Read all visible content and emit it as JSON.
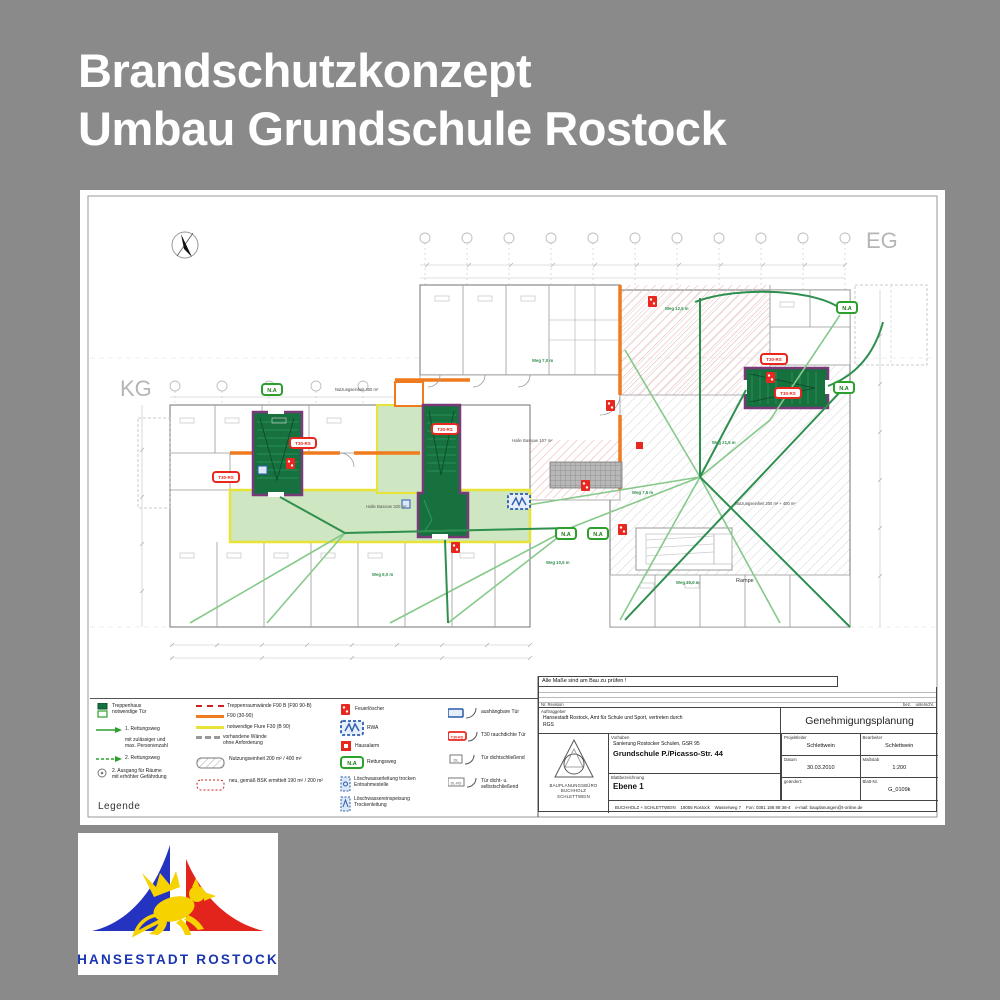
{
  "page": {
    "background": "#8a8a8a",
    "title_line1": "Brandschutzkonzept",
    "title_line2": "Umbau Grundschule Rostock"
  },
  "plan": {
    "floor_eg": "EG",
    "floor_kg": "KG",
    "rampe": "Rampe",
    "halle_small": "Halle Bassow 107 m²",
    "halle_big": "Halle Bassow 320 m²",
    "nutzungseinheit_1": "Nutzungseinheit 200 m² + 400 m²",
    "nutzungseinheit_2": "Nutzungseinheit 400 m²",
    "route_labels": [
      "Weg 7,0 m",
      "Weg 12,5 m",
      "Weg 21,5 m",
      "Weg 7,5 m",
      "Weg 10,5 m",
      "Weg 9,0 m",
      "Weg 30,0 m"
    ],
    "symbol_na": "N.A",
    "symbol_t30": "T30-RS",
    "symbol_rwa": "RWA"
  },
  "legend": {
    "heading": "Legende",
    "treppenhaus_line1": "Treppenhaus",
    "treppenhaus_line2": "notwendige Tür",
    "rettungsweg1": "1. Rettungsweg",
    "personen_line1": "mit zulässiger und",
    "personen_line2": "max. Personenzahl",
    "rettungsweg2": "2. Rettungsweg",
    "ausgang_line1": "2. Ausgang für Räume",
    "ausgang_line2": "mit erhöhter Gefährdung",
    "wall_f90b": "Treppenraumwände F90 B (F90 90-B)",
    "wall_f90": "F90  (30-90)",
    "wall_flur": "notwendige Flure F30 (B 90)",
    "wall_vorhanden_line1": "vorhandene Wände",
    "wall_vorhanden_line2": "ohne Anforderung",
    "nutzung": "Nutzungseinheit  200 m² / 400 m²",
    "nutzung_neu": "neu, gemäß BSK ermittelt  190 m² / 200 m²",
    "feuerloescher": "Feuerlöscher",
    "rwa": "RWA",
    "hausalarm": "Hausalarm",
    "rettungsweg_symbol": "Rettungsweg",
    "loeschwasser1_line1": "Löschwasserleitung trocken",
    "loeschwasser1_line2": "Entnahmestelle",
    "loeschwasser2_line1": "Löschwassereinspeisung",
    "loeschwasser2_line2": "Trockenleitung",
    "tuer_aushaengbar": "aushängbare Tür",
    "tuer_t30": "T30 rauchdichte Tür",
    "tuer_dicht": "Tür dichtschließend",
    "tuer_dicht_selbst": "Tür dicht- u. selbstschließend",
    "sym_t30": "T30-RS",
    "sym_dl": "DL",
    "sym_dlrs": "DL-RS",
    "sym_nr": "N.A"
  },
  "titleblock": {
    "note": "Alle Maße sind am Bau zu prüfen !",
    "rev_label": "Nr.  Revision",
    "rev_bez": "bez.",
    "rev_unterschrift": "unterschr.",
    "client_label": "Auftraggeber",
    "client_line1": "Hansestadt Rostock, Amt für Schule und Sport, vertreten durch",
    "client_line2": "RGS",
    "phase": "Genehmigungsplanung",
    "project_label": "Vorhaben",
    "project_line1": "Sanierung Rostocker Schulen, GSR 95",
    "project_line2": "Grundschule P./Picasso-Str. 44",
    "sheet_label": "Blattbezeichnung",
    "sheet_name": "Ebene 1",
    "pl_label": "Projektleiter",
    "pl_value": "Schlettwein",
    "bearbeiter_label": "Bearbeiter",
    "bearbeiter_value": "Schlettwein",
    "datum_label": "Datum",
    "datum_value": "30.03.2010",
    "massstab_label": "Maßstab",
    "massstab_value": "1:200",
    "geaendert_label": "geändert:",
    "blatt_label": "Blatt-Nr.",
    "blatt_value": "G_0109k",
    "firm_line1": "BAUPLANUNGSBÜRO",
    "firm_line2": "BUCHHOLZ",
    "firm_line3": "SCHLETTWEIN",
    "contact": "BUCHHOLZ + SCHLETTWEIN    18055 Rostock    Wasserweg 7    Fon: 0381 188 88 38-4    e-mail: bauplanungen@t-online.de"
  },
  "logo": {
    "caption": "HANSESTADT ROSTOCK"
  },
  "colors": {
    "accent_orange": "#f07a1e",
    "accent_yellow": "#e8e337",
    "escape_green": "#2f8f4f",
    "stair_green": "#17713f",
    "corridor_green": "#cfe6c2",
    "alert_red": "#e8281e",
    "logo_blue": "#2433c0",
    "logo_red": "#e3241d",
    "logo_yellow": "#f6d200"
  }
}
